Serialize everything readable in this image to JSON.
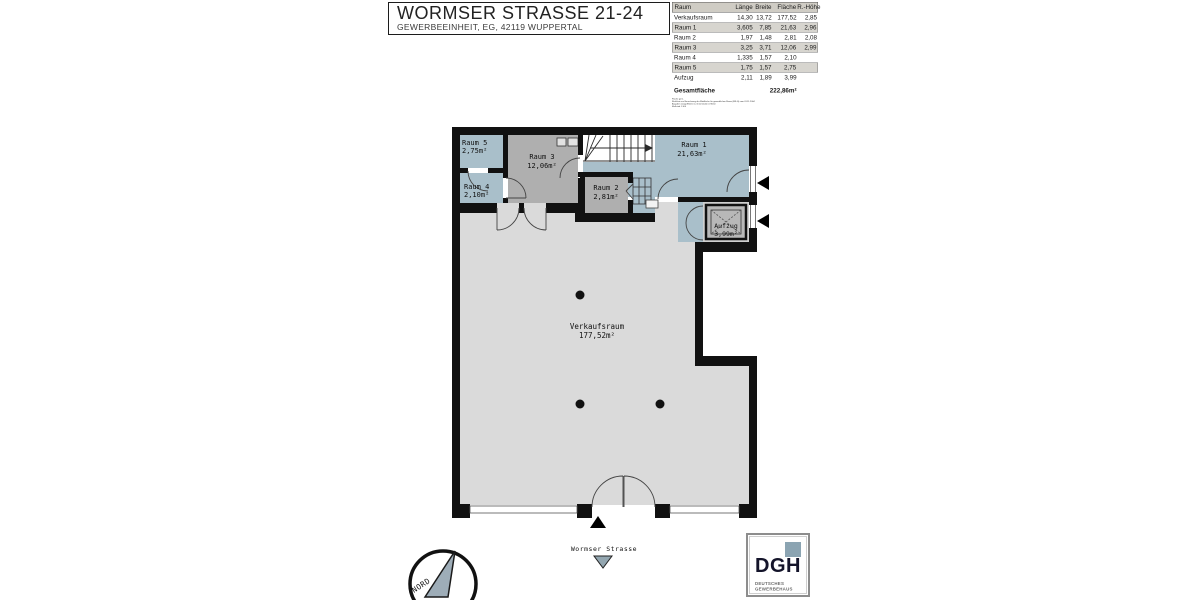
{
  "header": {
    "title": "WORMSER STRASSE 21-24",
    "subtitle": "GEWERBEEINHEIT, EG, 42119 WUPPERTAL"
  },
  "table": {
    "headers": [
      "Raum",
      "Länge",
      "Breite",
      "Fläche",
      "R.-Höhe"
    ],
    "rows": [
      {
        "name": "Verkaufsraum",
        "laenge": "14,30",
        "breite": "13,72",
        "flaeche": "177,52",
        "hoehe": "2,85",
        "highlight": false
      },
      {
        "name": "Raum 1",
        "laenge": "3,605",
        "breite": "7,85",
        "flaeche": "21,63",
        "hoehe": "2,96",
        "highlight": true
      },
      {
        "name": "Raum 2",
        "laenge": "1,97",
        "breite": "1,48",
        "flaeche": "2,81",
        "hoehe": "2,08",
        "highlight": false
      },
      {
        "name": "Raum 3",
        "laenge": "3,25",
        "breite": "3,71",
        "flaeche": "12,06",
        "hoehe": "2,99",
        "highlight": true
      },
      {
        "name": "Raum 4",
        "laenge": "1,335",
        "breite": "1,57",
        "flaeche": "2,10",
        "hoehe": "",
        "highlight": false
      },
      {
        "name": "Raum 5",
        "laenge": "1,75",
        "breite": "1,57",
        "flaeche": "2,75",
        "hoehe": "",
        "highlight": true
      },
      {
        "name": "Aufzug",
        "laenge": "2,11",
        "breite": "1,89",
        "flaeche": "3,99",
        "hoehe": "",
        "highlight": false
      }
    ],
    "total_label": "Gesamtfläche",
    "total_value": "222,86m²",
    "footnotes": [
      "Fläche gem.",
      "Richtlinie zur Berechnung der Mietfläche für gewerblichen Raum (MF-G) vom 01.11.2004",
      "Angaben Länge/Breite nur Innenmaße in Meter",
      "Maßstab 1:100"
    ]
  },
  "plan": {
    "rooms": [
      {
        "name": "Raum 5",
        "area": "2,75m²"
      },
      {
        "name": "Raum 4",
        "area": "2,10m²"
      },
      {
        "name": "Raum 3",
        "area": "12,06m²"
      },
      {
        "name": "Raum 2",
        "area": "2,81m²"
      },
      {
        "name": "Raum 1",
        "area": "21,63m²"
      },
      {
        "name": "Aufzug",
        "area": "3,99m²"
      },
      {
        "name": "Verkaufsraum",
        "area": "177,52m²"
      }
    ],
    "street_label": "Wormser Strasse",
    "compass_label": "NORD",
    "colors": {
      "room_blue": "#a9bfca",
      "room_gray": "#afafaf",
      "sales_gray": "#dadada",
      "wall": "#111111"
    }
  },
  "logo": {
    "abbr": "DGH",
    "line1": "DEUTSCHES",
    "line2": "GEWERBEHAUS",
    "square_color": "#8ba4b2"
  }
}
